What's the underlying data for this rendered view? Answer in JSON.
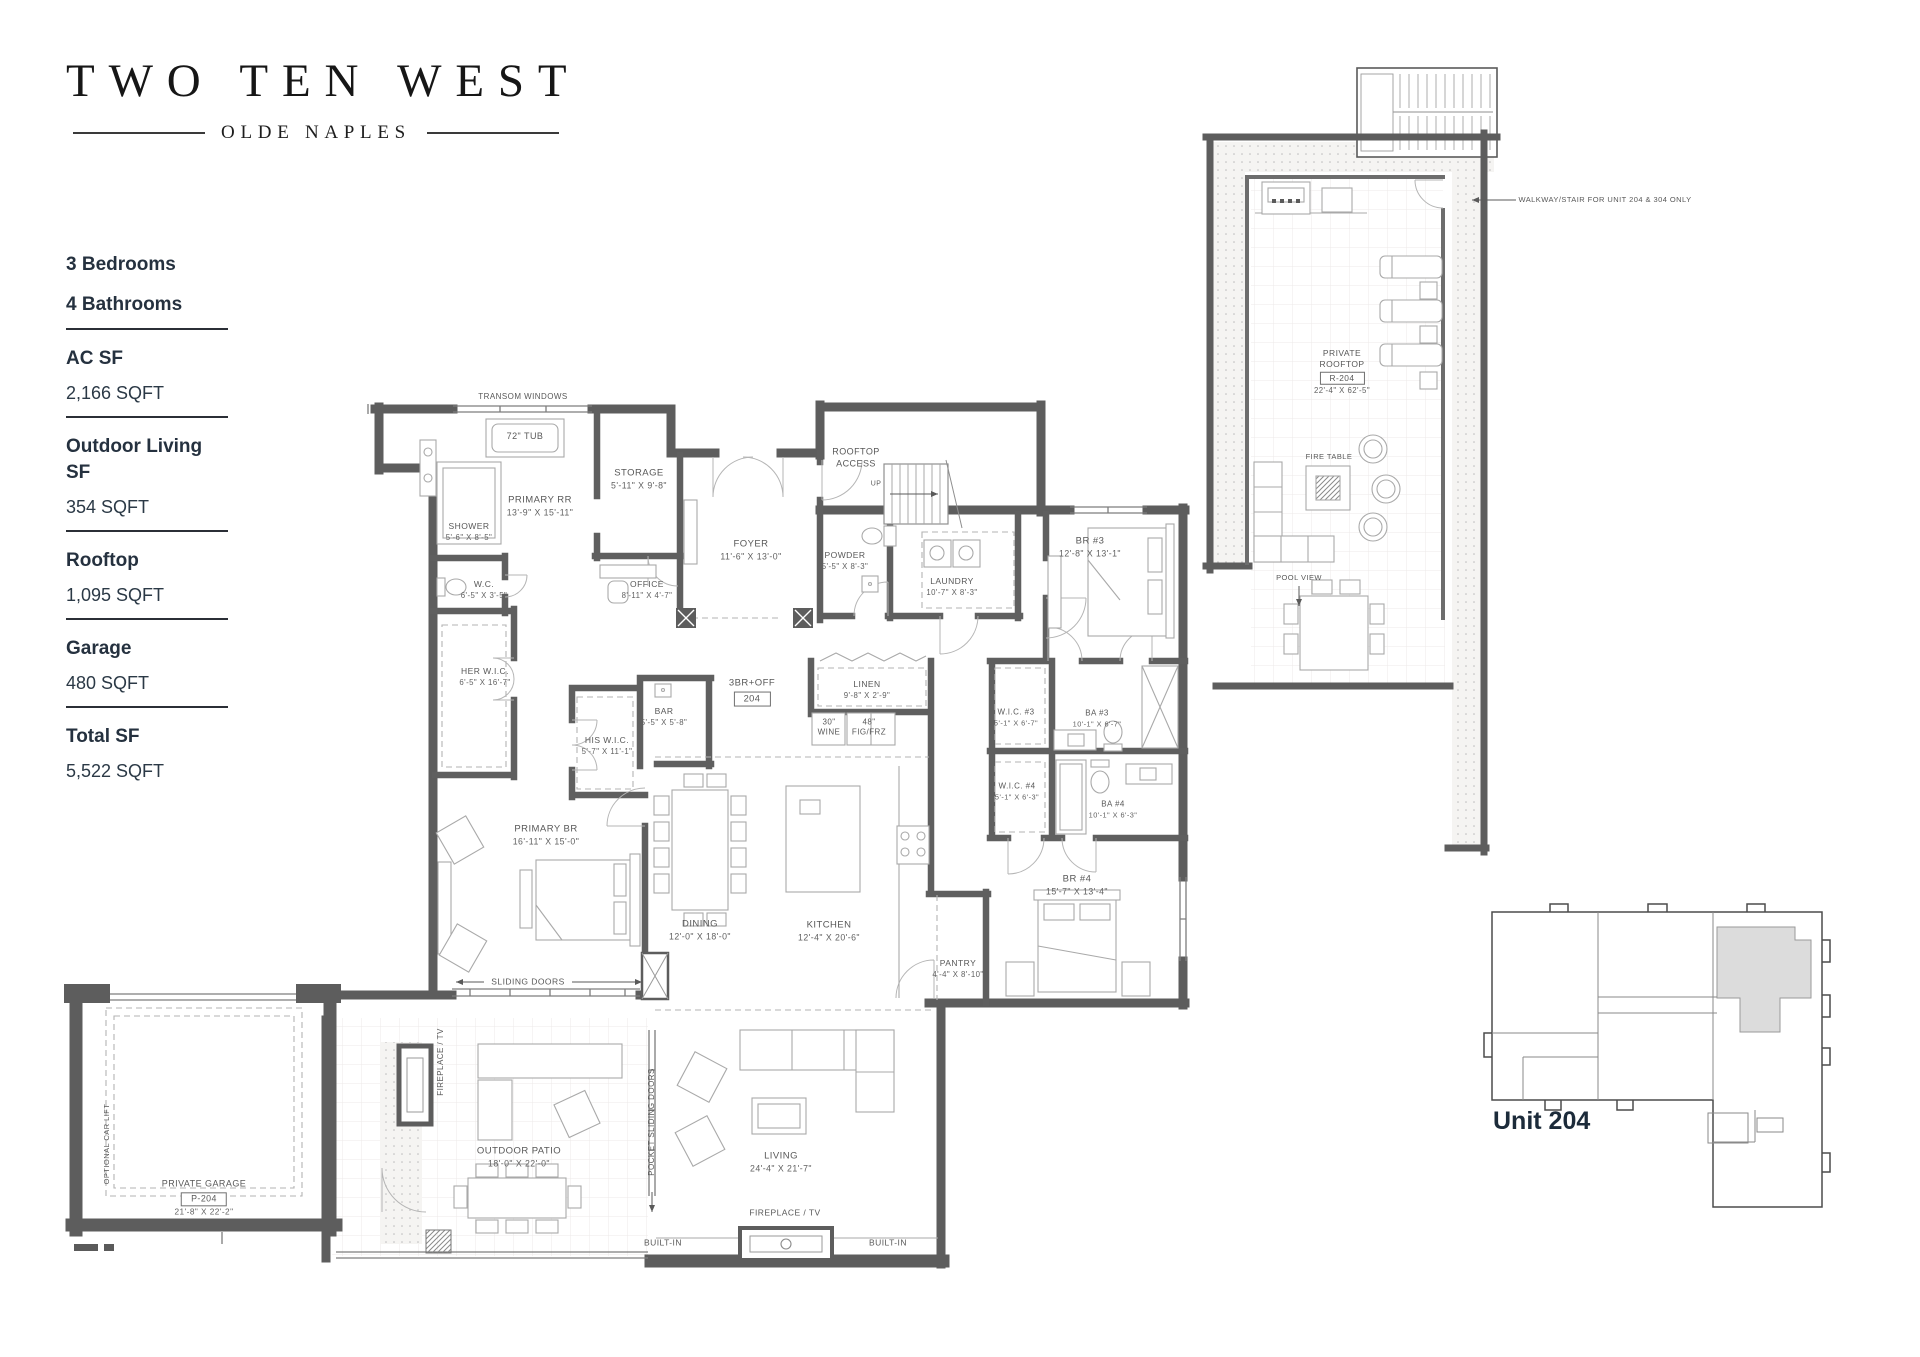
{
  "brand": {
    "title": "TWO TEN WEST",
    "subtitle": "OLDE NAPLES"
  },
  "specs": {
    "items": [
      {
        "label": "3 Bedrooms",
        "value": "",
        "underline": false
      },
      {
        "label": "4 Bathrooms",
        "value": "",
        "underline": true
      },
      {
        "label": "AC SF",
        "value": "2,166 SQFT",
        "underline": true
      },
      {
        "label": "Outdoor Living SF",
        "value": "354 SQFT",
        "underline": true
      },
      {
        "label": "Rooftop",
        "value": "1,095 SQFT",
        "underline": true
      },
      {
        "label": "Garage",
        "value": "480 SQFT",
        "underline": true
      },
      {
        "label": "Total SF",
        "value": "5,522 SQFT",
        "underline": false
      }
    ]
  },
  "key_plan": {
    "label": "Unit 204"
  },
  "plan_labels": [
    {
      "name": "transom-windows-note",
      "x": 523,
      "y": 397,
      "lines": [
        "TRANSOM WINDOWS"
      ],
      "fs": 8
    },
    {
      "name": "tub-label",
      "x": 525,
      "y": 437,
      "lines": [
        "72\" TUB"
      ],
      "fs": 9
    },
    {
      "name": "primary-rr-label",
      "x": 540,
      "y": 507,
      "lines": [
        "PRIMARY RR"
      ],
      "dims": "13'-9\" X 15'-11\""
    },
    {
      "name": "shower-label",
      "x": 469,
      "y": 532,
      "lines": [
        "SHOWER"
      ],
      "dims": "5'-6\" X 8'-5\"",
      "fs": 8.5
    },
    {
      "name": "wc-label",
      "x": 484,
      "y": 590,
      "lines": [
        "W.C."
      ],
      "dims": "6'-5\" X 3'-5\"",
      "fs": 8.5
    },
    {
      "name": "storage-label",
      "x": 639,
      "y": 480,
      "lines": [
        "STORAGE"
      ],
      "dims": "5'-11\" X 9'-8\""
    },
    {
      "name": "office-label",
      "x": 647,
      "y": 590,
      "lines": [
        "OFFICE"
      ],
      "dims": "8'-11\" X 4'-7\"",
      "fs": 8.5
    },
    {
      "name": "foyer-label",
      "x": 751,
      "y": 551,
      "lines": [
        "FOYER"
      ],
      "dims": "11'-6\" X 13'-0\""
    },
    {
      "name": "rooftop-access-label",
      "x": 856,
      "y": 458,
      "lines": [
        "ROOFTOP",
        "ACCESS"
      ],
      "fs": 9
    },
    {
      "name": "up-label",
      "x": 876,
      "y": 484,
      "lines": [
        "UP"
      ],
      "fs": 7
    },
    {
      "name": "powder-label",
      "x": 845,
      "y": 561,
      "lines": [
        "POWDER"
      ],
      "dims": "5'-5\" X 8'-3\"",
      "fs": 8.5
    },
    {
      "name": "laundry-label",
      "x": 952,
      "y": 587,
      "lines": [
        "LAUNDRY"
      ],
      "dims": "10'-7\" X 8'-3\"",
      "fs": 8.5
    },
    {
      "name": "br3-label",
      "x": 1090,
      "y": 548,
      "lines": [
        "BR #3"
      ],
      "dims": "12'-8\" X 13'-1\""
    },
    {
      "name": "her-wic-label",
      "x": 485,
      "y": 677,
      "lines": [
        "HER W.I.C."
      ],
      "dims": "6'-5\" X 16'-7\"",
      "fs": 8.5
    },
    {
      "name": "his-wic-label",
      "x": 607,
      "y": 746,
      "lines": [
        "HIS W.I.C."
      ],
      "dims": "5'-7\" X 11'-1\"",
      "fs": 8.5
    },
    {
      "name": "bar-label",
      "x": 664,
      "y": 717,
      "lines": [
        "BAR"
      ],
      "dims": "5'-5\" X 5'-8\"",
      "fs": 8.5
    },
    {
      "name": "unit-number-tag",
      "x": 752,
      "y": 692,
      "lines": [
        "3BR+OFF"
      ],
      "box": "204"
    },
    {
      "name": "linen-label",
      "x": 867,
      "y": 690,
      "lines": [
        "LINEN"
      ],
      "dims": "9'-8\" X 2'-9\"",
      "fs": 8.5
    },
    {
      "name": "wine-label",
      "x": 829,
      "y": 728,
      "lines": [
        "30\"",
        "WINE"
      ],
      "fs": 8
    },
    {
      "name": "fridge-freezer-label",
      "x": 869,
      "y": 728,
      "lines": [
        "48\"",
        "FIG/FRZ"
      ],
      "fs": 8
    },
    {
      "name": "wic3-label",
      "x": 1016,
      "y": 718,
      "lines": [
        "W.I.C. #3"
      ],
      "dims": "5'-1\" X 6'-7\"",
      "fs": 8
    },
    {
      "name": "ba3-label",
      "x": 1097,
      "y": 719,
      "lines": [
        "BA #3"
      ],
      "dims": "10'-1\" X 6'-7\"",
      "fs": 8
    },
    {
      "name": "wic4-label",
      "x": 1017,
      "y": 792,
      "lines": [
        "W.I.C. #4"
      ],
      "dims": "5'-1\" X 6'-3\"",
      "fs": 8
    },
    {
      "name": "ba4-label",
      "x": 1113,
      "y": 810,
      "lines": [
        "BA #4"
      ],
      "dims": "10'-1\" X 6'-3\"",
      "fs": 8
    },
    {
      "name": "primary-br-label",
      "x": 546,
      "y": 836,
      "lines": [
        "PRIMARY BR"
      ],
      "dims": "16'-11\" X 15'-0\""
    },
    {
      "name": "dining-label",
      "x": 700,
      "y": 931,
      "lines": [
        "DINING"
      ],
      "dims": "12'-0\" X 18'-0\""
    },
    {
      "name": "kitchen-label",
      "x": 829,
      "y": 932,
      "lines": [
        "KITCHEN"
      ],
      "dims": "12'-4\" X 20'-6\""
    },
    {
      "name": "pantry-label",
      "x": 958,
      "y": 969,
      "lines": [
        "PANTRY"
      ],
      "dims": "4'-4\" X 8'-10\"",
      "fs": 8.5
    },
    {
      "name": "br4-label",
      "x": 1077,
      "y": 886,
      "lines": [
        "BR #4"
      ],
      "dims": "15'-7\" X 13'-4\""
    },
    {
      "name": "sliding-doors-label",
      "x": 528,
      "y": 982,
      "lines": [
        "SLIDING DOORS"
      ],
      "fs": 8.5
    },
    {
      "name": "fireplace-tv-patio-label",
      "x": 441,
      "y": 1062,
      "lines": [
        "FIREPLACE / TV"
      ],
      "fs": 8,
      "rot": -90
    },
    {
      "name": "outdoor-patio-label",
      "x": 519,
      "y": 1158,
      "lines": [
        "OUTDOOR PATIO"
      ],
      "dims": "18'-0\" X 22'-0\""
    },
    {
      "name": "pocket-sliding-doors-label",
      "x": 652,
      "y": 1122,
      "lines": [
        "POCKET SLIDING DOORS"
      ],
      "fs": 8,
      "rot": -90
    },
    {
      "name": "living-label",
      "x": 781,
      "y": 1163,
      "lines": [
        "LIVING"
      ],
      "dims": "24'-4\" X 21'-7\""
    },
    {
      "name": "fireplace-tv-living-label",
      "x": 785,
      "y": 1213,
      "lines": [
        "FIREPLACE / TV"
      ],
      "fs": 8.5
    },
    {
      "name": "builtin-left-label",
      "x": 663,
      "y": 1243,
      "lines": [
        "BUILT-IN"
      ],
      "fs": 8.5
    },
    {
      "name": "builtin-right-label",
      "x": 888,
      "y": 1243,
      "lines": [
        "BUILT-IN"
      ],
      "fs": 8.5
    },
    {
      "name": "optional-car-lift-label",
      "x": 107,
      "y": 1144,
      "lines": [
        "OPTIONAL CAR LIFT"
      ],
      "fs": 7.5,
      "rot": -90
    },
    {
      "name": "private-garage-label",
      "x": 204,
      "y": 1198,
      "lines": [
        "PRIVATE GARAGE"
      ],
      "box": "P-204",
      "dims": "21'-8\" X 22'-2\"",
      "fs": 9
    },
    {
      "name": "walkway-stair-note",
      "x": 1605,
      "y": 200,
      "lines": [
        "WALKWAY/STAIR FOR UNIT 204 & 304 ONLY"
      ],
      "fs": 7.5
    },
    {
      "name": "private-rooftop-label",
      "x": 1342,
      "y": 372,
      "lines": [
        "PRIVATE",
        "ROOFTOP"
      ],
      "box": "R-204",
      "dims": "22'-4\" X 62'-5\"",
      "fs": 8.5
    },
    {
      "name": "fire-table-label",
      "x": 1329,
      "y": 457,
      "lines": [
        "FIRE TABLE"
      ],
      "fs": 7.5
    },
    {
      "name": "pool-view-label",
      "x": 1299,
      "y": 578,
      "lines": [
        "POOL VIEW"
      ],
      "fs": 7.5
    }
  ]
}
